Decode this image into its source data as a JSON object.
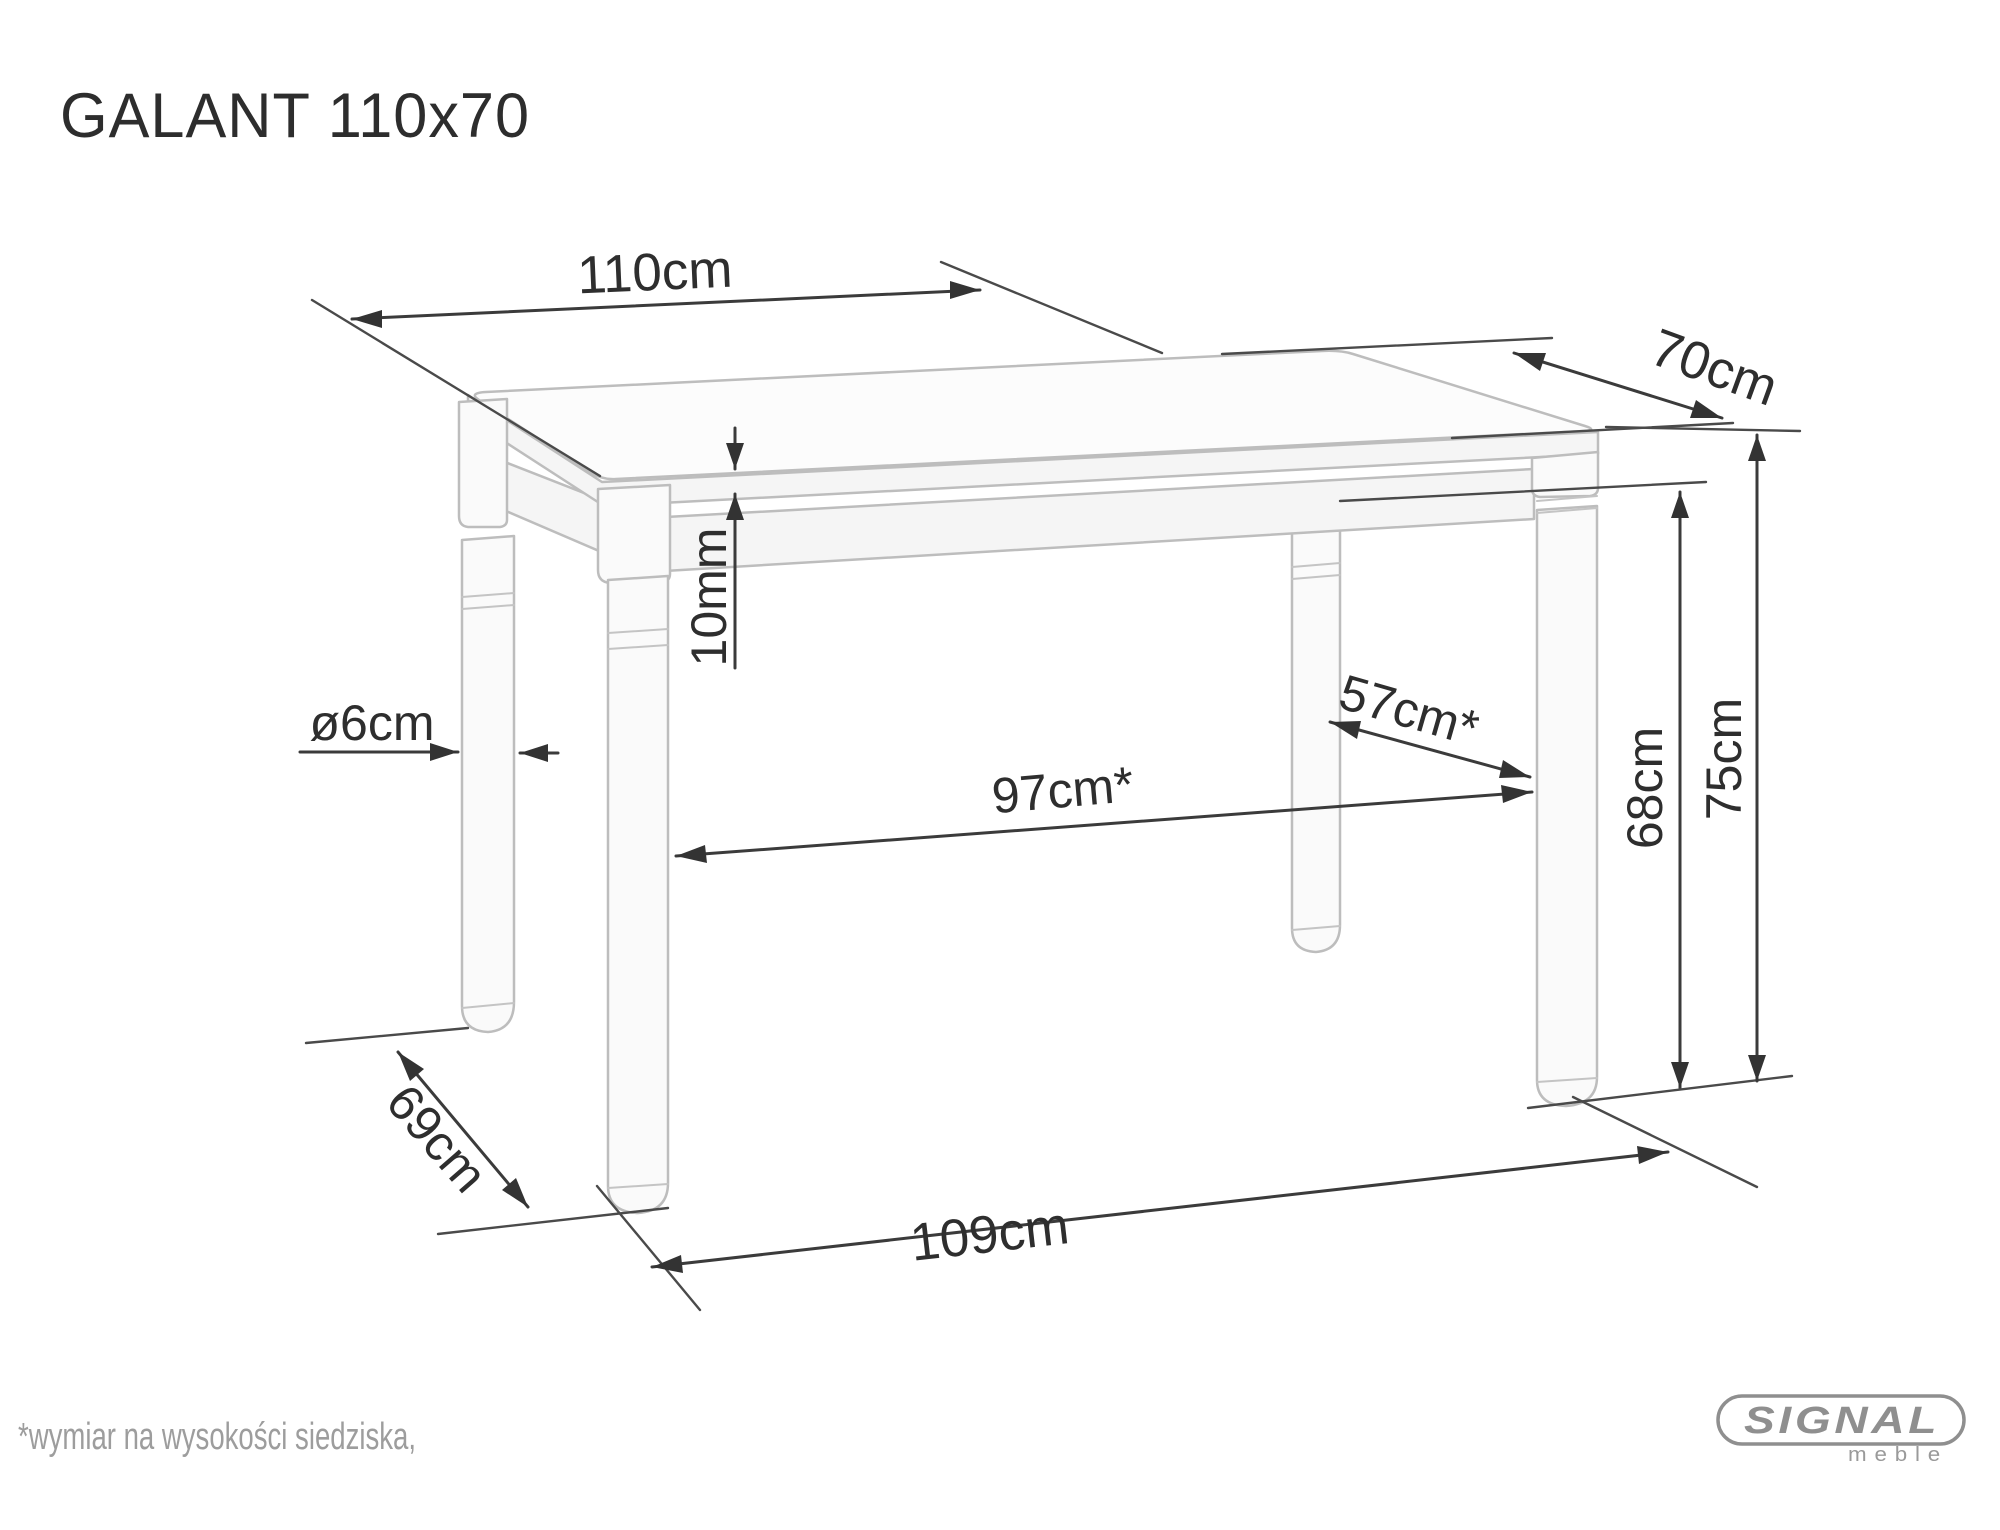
{
  "title": "GALANT 110x70",
  "dimensions": {
    "top_width": "110cm",
    "top_depth": "70cm",
    "top_thickness": "10mm",
    "leg_diameter": "ø6cm",
    "inner_span_depth": "57cm*",
    "inner_span_width": "97cm*",
    "underside_height": "68cm",
    "total_height": "75cm",
    "outer_span_depth": "69cm",
    "outer_span_width": "109cm"
  },
  "footnote": "*wymiar na wysokości siedziska,",
  "logo": {
    "brand": "SIGNAL",
    "subtitle": "meble"
  },
  "colors": {
    "background": "#ffffff",
    "dimension_lines": "#3b3b3b",
    "drawing_lines": "#bdbdbd",
    "label_text": "#2e2e2e",
    "footnote_text": "#9d9d9d",
    "logo_gray": "#8f8f8f"
  }
}
